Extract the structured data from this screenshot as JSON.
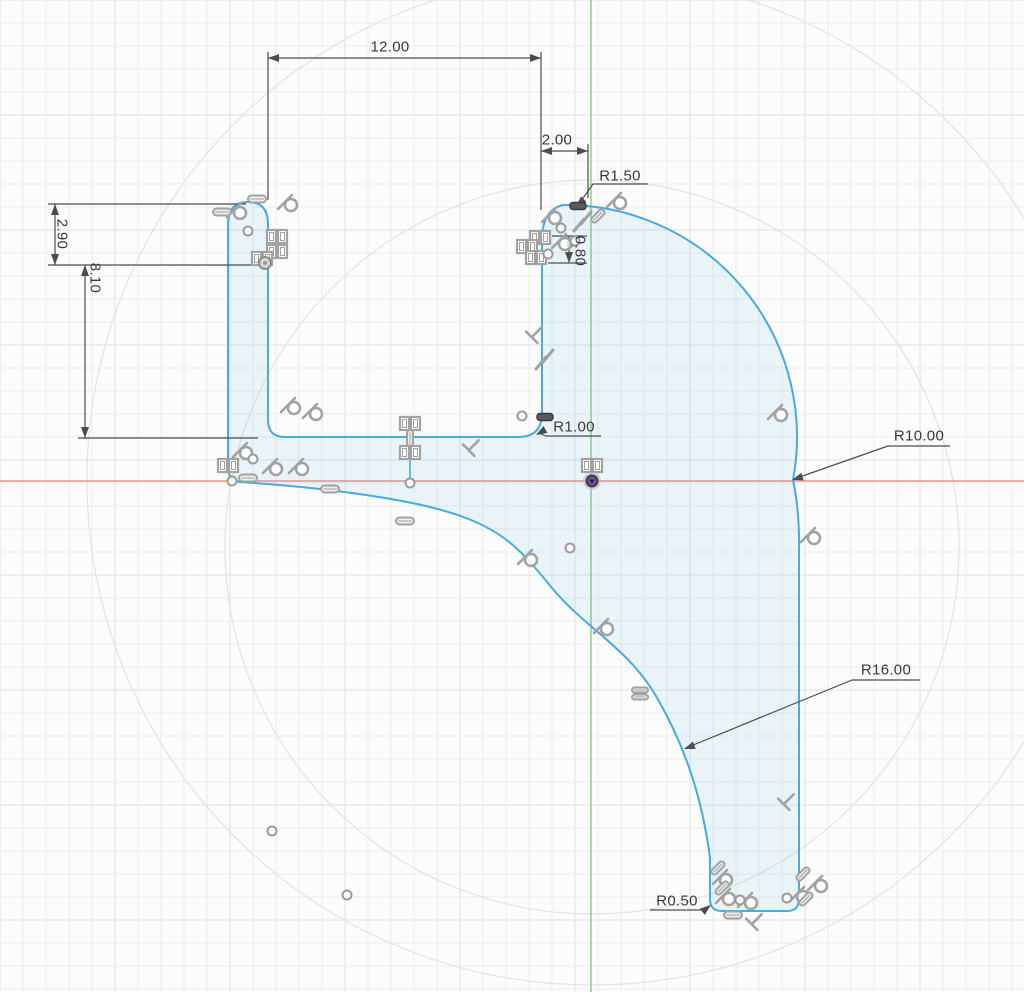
{
  "app": {
    "name": "cad-sketch-view",
    "description": "2D sketch canvas with dimensioned profile",
    "background": "#fcfcfc"
  },
  "grid": {
    "minor": 23,
    "major": 115,
    "minor_color": "#ececec",
    "major_color": "#e0e0e0",
    "width": 1024,
    "height": 992
  },
  "axes": {
    "x_axis": {
      "y": 481,
      "color": "#ef908d"
    },
    "y_axis": {
      "x": 591,
      "color": "#8fd48f"
    }
  },
  "construction_circles": [
    {
      "cx": 592,
      "cy": 547,
      "r": 367
    },
    {
      "cx": 592,
      "cy": 480,
      "r": 505
    }
  ],
  "sketch": {
    "stroke": "#44ace1",
    "fill": "rgba(68,172,225,0.10)",
    "outline_path": "M 228,224 C 228,206 238,202 248,202 C 258,202 268,206 268,224 L 268,420 Q 268,437 285,437 L 518,437 Q 542,437 542,413 L 542,240 Q 542,210 563,205 A 232 232 0 0 1 793 480 Q 800,512 799,555 L 799,899 Q 799,911 787,911 L 722,911 Q 710,911 710,899 L 710,858 C 702,796 684,744 656,696 C 628,648 585,628 552,588 C 524,554 508,534 466,518 C 420,500 330,488 240,482 Q 228,480 228,468 Z",
    "extra_lines": [
      {
        "x1": 410,
        "y1": 438,
        "x2": 410,
        "y2": 482
      }
    ]
  },
  "origin_point": {
    "x": 592,
    "y": 481,
    "halo": "#bcbcbc",
    "ring": "#3d3d3d",
    "dot": "#6b4fa0"
  },
  "points_open": [
    [
      248,
      231
    ],
    [
      522,
      416
    ],
    [
      410,
      483
    ],
    [
      570,
      548
    ],
    [
      272,
      831
    ],
    [
      347,
      895
    ],
    [
      232,
      481
    ],
    [
      253,
      459
    ],
    [
      561,
      228
    ],
    [
      575,
      241
    ],
    [
      548,
      254
    ],
    [
      740,
      900
    ],
    [
      787,
      898
    ]
  ],
  "dimension_style": {
    "color": "#4d4d4d"
  },
  "dimensions": {
    "segments": [
      [
        268,
        52,
        268,
        200
      ],
      [
        541,
        52,
        541,
        210
      ],
      [
        268,
        58,
        541,
        58
      ],
      [
        588,
        144,
        588,
        198
      ],
      [
        541,
        151,
        588,
        151
      ],
      [
        48,
        204,
        246,
        204
      ],
      [
        48,
        265,
        268,
        265
      ],
      [
        55,
        204,
        55,
        265
      ],
      [
        85,
        265,
        85,
        438
      ],
      [
        78,
        438,
        258,
        438
      ],
      [
        552,
        236,
        587,
        236
      ],
      [
        548,
        263,
        587,
        263
      ],
      [
        569,
        236,
        569,
        263
      ],
      [
        593,
        184,
        648,
        184
      ],
      [
        593,
        184,
        578,
        205
      ],
      [
        546,
        436,
        601,
        436
      ],
      [
        546,
        436,
        538,
        433
      ],
      [
        888,
        446,
        950,
        446
      ],
      [
        888,
        446,
        794,
        479
      ],
      [
        852,
        680,
        920,
        680
      ],
      [
        852,
        680,
        686,
        748
      ],
      [
        650,
        910,
        702,
        910
      ],
      [
        702,
        910,
        710,
        906
      ]
    ],
    "arrows": [
      [
        268,
        58,
        180
      ],
      [
        541,
        58,
        0
      ],
      [
        541,
        151,
        180
      ],
      [
        588,
        151,
        0
      ],
      [
        55,
        204,
        270
      ],
      [
        55,
        265,
        90
      ],
      [
        85,
        265,
        270
      ],
      [
        85,
        438,
        90
      ],
      [
        569,
        236,
        270
      ],
      [
        569,
        263,
        90
      ],
      [
        576,
        207,
        135
      ],
      [
        536,
        435,
        150
      ],
      [
        792,
        480,
        162
      ],
      [
        684,
        749,
        160
      ],
      [
        711,
        905,
        -38
      ]
    ]
  },
  "labels": {
    "d12": {
      "text": "12.00",
      "x": 390,
      "y": 47,
      "rot": 0
    },
    "d2": {
      "text": "2.00",
      "x": 557,
      "y": 140,
      "rot": 0
    },
    "d290": {
      "text": "2.90",
      "x": 62,
      "y": 234,
      "rot": 90
    },
    "d810": {
      "text": "8.10",
      "x": 95,
      "y": 278,
      "rot": 90
    },
    "d080": {
      "text": "0.80",
      "x": 580,
      "y": 251,
      "rot": 90
    },
    "r150": {
      "text": "R1.50",
      "x": 620,
      "y": 176,
      "rot": 0
    },
    "r100": {
      "text": "R1.00",
      "x": 574,
      "y": 427,
      "rot": 0
    },
    "r1000": {
      "text": "R10.00",
      "x": 919,
      "y": 436,
      "rot": 0
    },
    "r1600": {
      "text": "R16.00",
      "x": 886,
      "y": 670,
      "rot": 0
    },
    "r050": {
      "text": "R0.50",
      "x": 677,
      "y": 901,
      "rot": 0
    }
  },
  "constraint_icons": {
    "color": "#a2a2a2",
    "items": [
      {
        "t": "tangent",
        "x": 238,
        "y": 211
      },
      {
        "t": "tangent",
        "x": 289,
        "y": 203
      },
      {
        "t": "tangent",
        "x": 292,
        "y": 406
      },
      {
        "t": "tangent",
        "x": 314,
        "y": 412
      },
      {
        "t": "tangent",
        "x": 244,
        "y": 451
      },
      {
        "t": "tangent",
        "x": 274,
        "y": 467
      },
      {
        "t": "tangent",
        "x": 300,
        "y": 467
      },
      {
        "t": "tangent",
        "x": 529,
        "y": 558
      },
      {
        "t": "tangent",
        "x": 605,
        "y": 627
      },
      {
        "t": "tangent",
        "x": 779,
        "y": 413
      },
      {
        "t": "tangent",
        "x": 812,
        "y": 536
      },
      {
        "t": "tangent",
        "x": 618,
        "y": 201
      },
      {
        "t": "tangent",
        "x": 553,
        "y": 216
      },
      {
        "t": "tangent",
        "x": 563,
        "y": 242
      },
      {
        "t": "tangent",
        "x": 724,
        "y": 878
      },
      {
        "t": "tangent",
        "x": 727,
        "y": 897
      },
      {
        "t": "tangent",
        "x": 749,
        "y": 901
      },
      {
        "t": "tangent",
        "x": 801,
        "y": 895
      },
      {
        "t": "tangent",
        "x": 819,
        "y": 884
      },
      {
        "t": "sq",
        "x": 277,
        "y": 237
      },
      {
        "t": "sq",
        "x": 277,
        "y": 252
      },
      {
        "t": "sq",
        "x": 262,
        "y": 259
      },
      {
        "t": "sq",
        "x": 228,
        "y": 466
      },
      {
        "t": "sq",
        "x": 410,
        "y": 424
      },
      {
        "t": "sq",
        "x": 410,
        "y": 453
      },
      {
        "t": "sq",
        "x": 592,
        "y": 466
      },
      {
        "t": "sq",
        "x": 540,
        "y": 238
      },
      {
        "t": "sq",
        "x": 527,
        "y": 247
      },
      {
        "t": "sq",
        "x": 536,
        "y": 258
      },
      {
        "t": "pill",
        "x": 222,
        "y": 212
      },
      {
        "t": "pill",
        "x": 257,
        "y": 199
      },
      {
        "t": "pill",
        "x": 330,
        "y": 489
      },
      {
        "t": "pill",
        "x": 405,
        "y": 521
      },
      {
        "t": "pill",
        "x": 248,
        "y": 478
      },
      {
        "t": "pill",
        "x": 733,
        "y": 915
      },
      {
        "t": "vpill",
        "x": 410,
        "y": 438
      },
      {
        "t": "dpill",
        "x": 718,
        "y": 868
      },
      {
        "t": "dpill",
        "x": 806,
        "y": 899
      },
      {
        "t": "dpill",
        "x": 803,
        "y": 874
      },
      {
        "t": "dpill",
        "x": 598,
        "y": 216
      },
      {
        "t": "dpill",
        "x": 722,
        "y": 888
      },
      {
        "t": "equal",
        "x": 547,
        "y": 360
      },
      {
        "t": "equal",
        "x": 585,
        "y": 222
      },
      {
        "t": "dblpill",
        "x": 640,
        "y": 690
      },
      {
        "t": "perp",
        "x": 473,
        "y": 446
      },
      {
        "t": "perp",
        "x": 536,
        "y": 333
      },
      {
        "t": "perp",
        "x": 756,
        "y": 920
      },
      {
        "t": "perp",
        "x": 788,
        "y": 800
      },
      {
        "t": "gripdark",
        "x": 545,
        "y": 417
      },
      {
        "t": "gripdark",
        "x": 578,
        "y": 206
      },
      {
        "t": "gripring",
        "x": 265,
        "y": 263
      }
    ]
  }
}
